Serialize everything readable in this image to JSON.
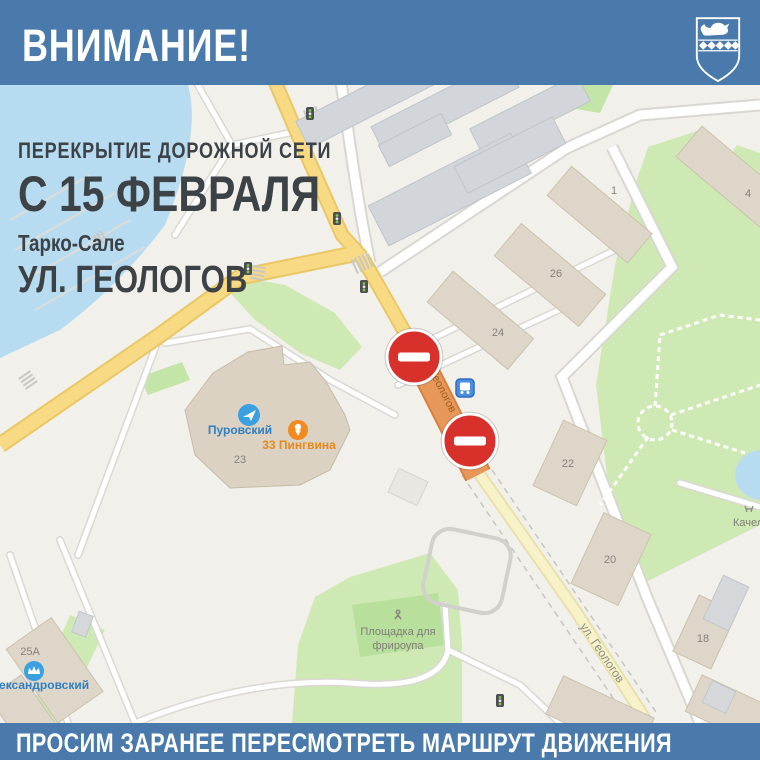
{
  "banner_top": {
    "text": "ВНИМАНИЕ!"
  },
  "banner_bottom": {
    "text": "ПРОСИМ ЗАРАНЕЕ ПЕРЕСМОТРЕТЬ МАРШРУТ ДВИЖЕНИЯ"
  },
  "overlay": {
    "line1": "ПЕРЕКРЫТИЕ  ДОРОЖНОЙ СЕТИ",
    "line2": "С 15 ФЕВРАЛЯ",
    "line3": "Тарко-Сале",
    "line4": "УЛ. ГЕОЛОГОВ"
  },
  "colors": {
    "banner_blue": "#4a7aac",
    "closure_orange": "#e8975a",
    "no_entry_red": "#d8312c",
    "water_blue": "#b7dcf2",
    "park_green": "#cfe9b4"
  },
  "map": {
    "street_label": "ул. Геологов",
    "building_numbers": [
      "1",
      "4",
      "26",
      "24",
      "22",
      "20",
      "18",
      "23",
      "25А"
    ],
    "poi": {
      "purovsky": "Пуровский",
      "penguins": "33 Пингвина",
      "alexandrovsky": "Александровский",
      "freerope_line1": "Площадка для",
      "freerope_line2": "фрироупа",
      "swings": "Качели"
    }
  }
}
